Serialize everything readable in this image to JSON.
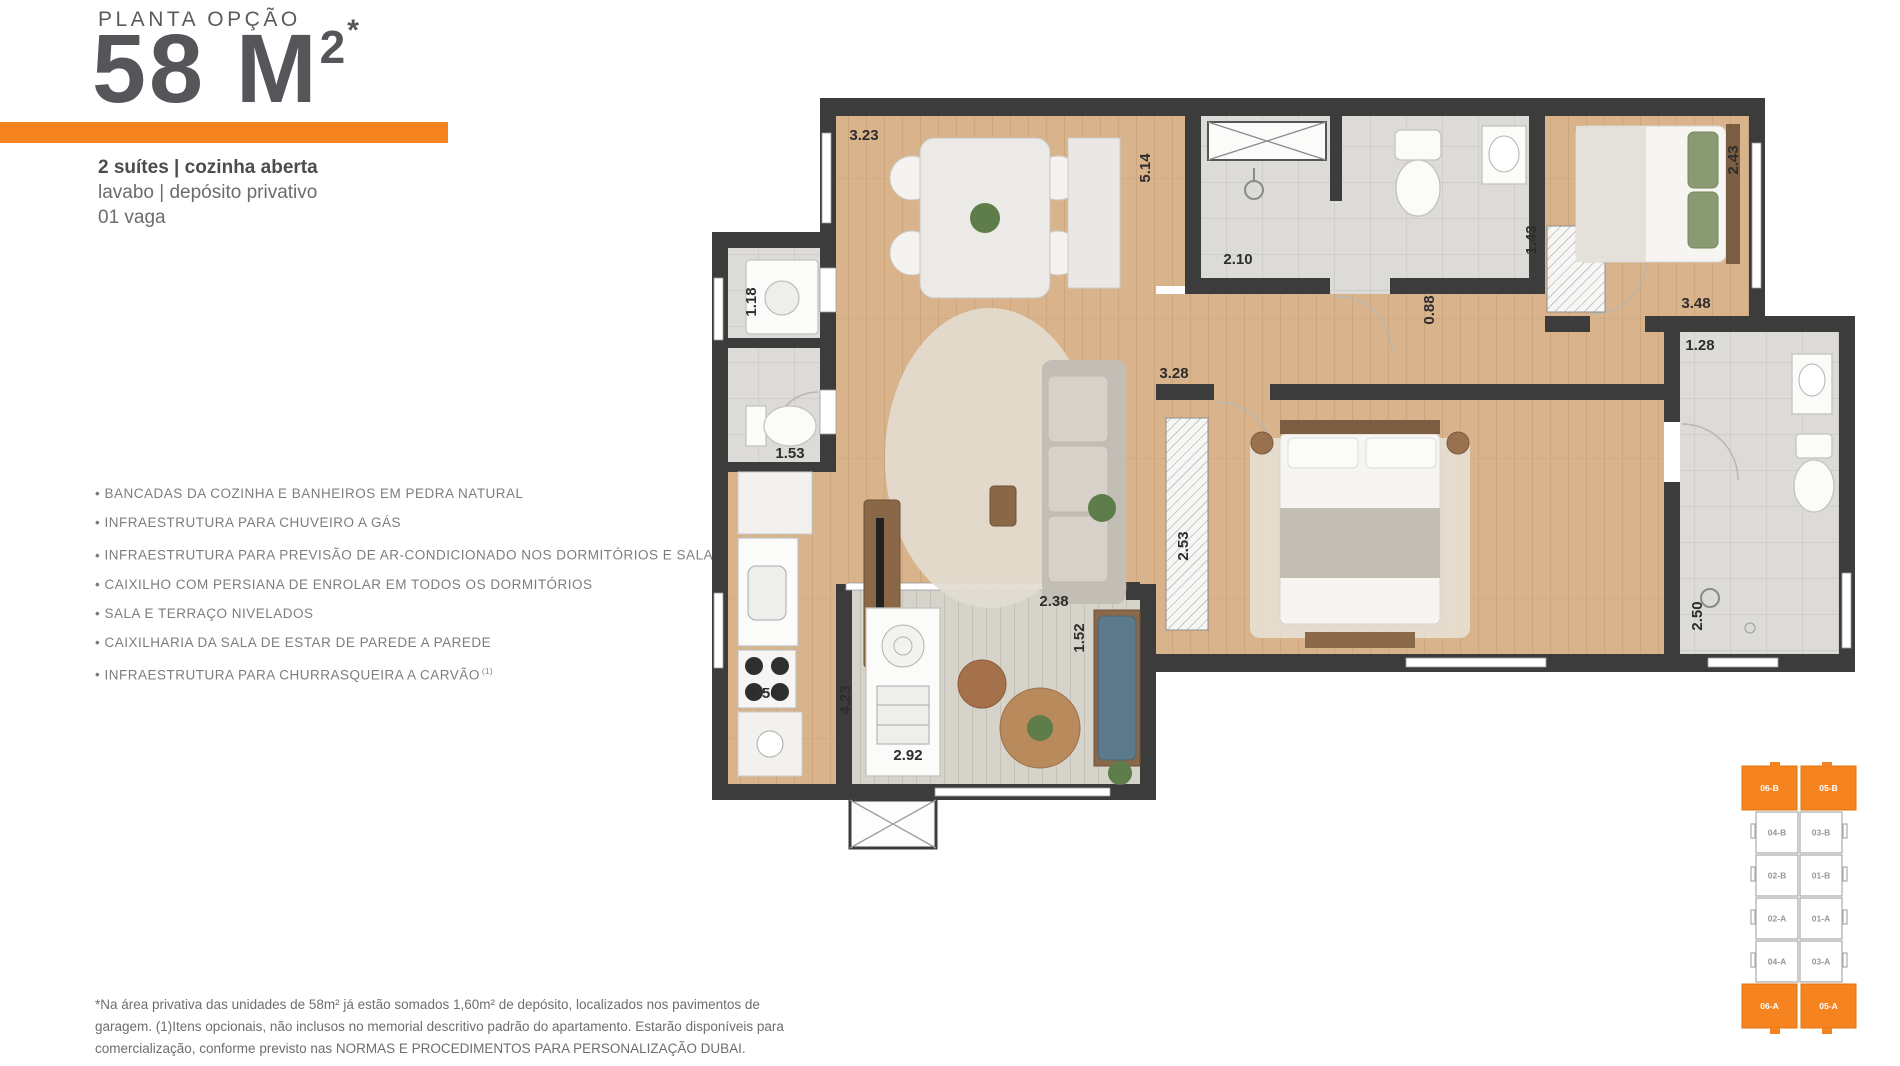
{
  "header": {
    "kicker": "PLANTA OPÇÃO",
    "area_main": "58 M",
    "area_sup": "2",
    "area_asterisk": "*"
  },
  "specs": {
    "line1": "2 suítes | cozinha aberta",
    "line2": "lavabo | depósito privativo",
    "line3": "01 vaga"
  },
  "features": [
    {
      "text": "BANCADAS DA COZINHA E BANHEIROS EM PEDRA NATURAL",
      "sup": ""
    },
    {
      "text": "INFRAESTRUTURA PARA CHUVEIRO A GÁS",
      "sup": ""
    },
    {
      "text": "INFRAESTRUTURA PARA PREVISÃO DE AR-CONDICIONADO NOS DORMITÓRIOS E SALA",
      "sup": "(1)"
    },
    {
      "text": "CAIXILHO COM PERSIANA DE ENROLAR EM TODOS OS DORMITÓRIOS",
      "sup": ""
    },
    {
      "text": "SALA E TERRAÇO NIVELADOS",
      "sup": ""
    },
    {
      "text": "CAIXILHARIA DA SALA DE ESTAR DE PAREDE A PAREDE",
      "sup": ""
    },
    {
      "text": "INFRAESTRUTURA PARA CHURRASQUEIRA A CARVÃO",
      "sup": "(1)"
    }
  ],
  "disclaimer": {
    "line1": "*Na área privativa das unidades de 58m² já estão somados 1,60m² de depósito, localizados nos pavimentos de",
    "line2": "garagem. (1)Itens opcionais, não inclusos no memorial descritivo padrão do apartamento. Estarão disponíveis para",
    "line3": "comercialização, conforme previsto nas NORMAS E PROCEDIMENTOS PARA PERSONALIZAÇÃO DUBAI."
  },
  "floorplan": {
    "dimensions": [
      {
        "v": "3.23",
        "o": "h",
        "x": 214,
        "y": 102
      },
      {
        "v": "5.14",
        "o": "v",
        "x": 500,
        "y": 130
      },
      {
        "v": "2.10",
        "o": "h",
        "x": 588,
        "y": 226
      },
      {
        "v": "1.43",
        "o": "v",
        "x": 886,
        "y": 202
      },
      {
        "v": "2.43",
        "o": "v",
        "x": 1088,
        "y": 122
      },
      {
        "v": "3.48",
        "o": "h",
        "x": 1046,
        "y": 270
      },
      {
        "v": "0.88",
        "o": "v",
        "x": 784,
        "y": 272
      },
      {
        "v": "1.18",
        "o": "v",
        "x": 106,
        "y": 264
      },
      {
        "v": "1.53",
        "o": "h",
        "x": 140,
        "y": 420
      },
      {
        "v": "3.28",
        "o": "h",
        "x": 524,
        "y": 340
      },
      {
        "v": "2.53",
        "o": "v",
        "x": 538,
        "y": 508
      },
      {
        "v": "1.28",
        "o": "h",
        "x": 1050,
        "y": 312
      },
      {
        "v": "2.50",
        "o": "v",
        "x": 1052,
        "y": 578
      },
      {
        "v": "2.38",
        "o": "h",
        "x": 404,
        "y": 568
      },
      {
        "v": "1.52",
        "o": "v",
        "x": 434,
        "y": 600
      },
      {
        "v": "4.23",
        "o": "v",
        "x": 200,
        "y": 662
      },
      {
        "v": "2.92",
        "o": "h",
        "x": 258,
        "y": 722
      },
      {
        "v": "1.50",
        "o": "h",
        "x": 114,
        "y": 660
      }
    ]
  },
  "keyplan": {
    "rows": [
      {
        "left": "06-B",
        "right": "05-B",
        "highlight": true
      },
      {
        "left": "04-B",
        "right": "03-B",
        "highlight": false
      },
      {
        "left": "02-B",
        "right": "01-B",
        "highlight": false
      },
      {
        "left": "02-A",
        "right": "01-A",
        "highlight": false
      },
      {
        "left": "04-A",
        "right": "03-A",
        "highlight": false
      },
      {
        "left": "06-A",
        "right": "05-A",
        "highlight": true
      }
    ]
  },
  "colors": {
    "accent": "#F5831F",
    "title": "#55565A",
    "wall": "#3C3C3C",
    "wood": "#D9B38C",
    "tile": "#DCDBD7",
    "deck": "#D6D3CB"
  }
}
